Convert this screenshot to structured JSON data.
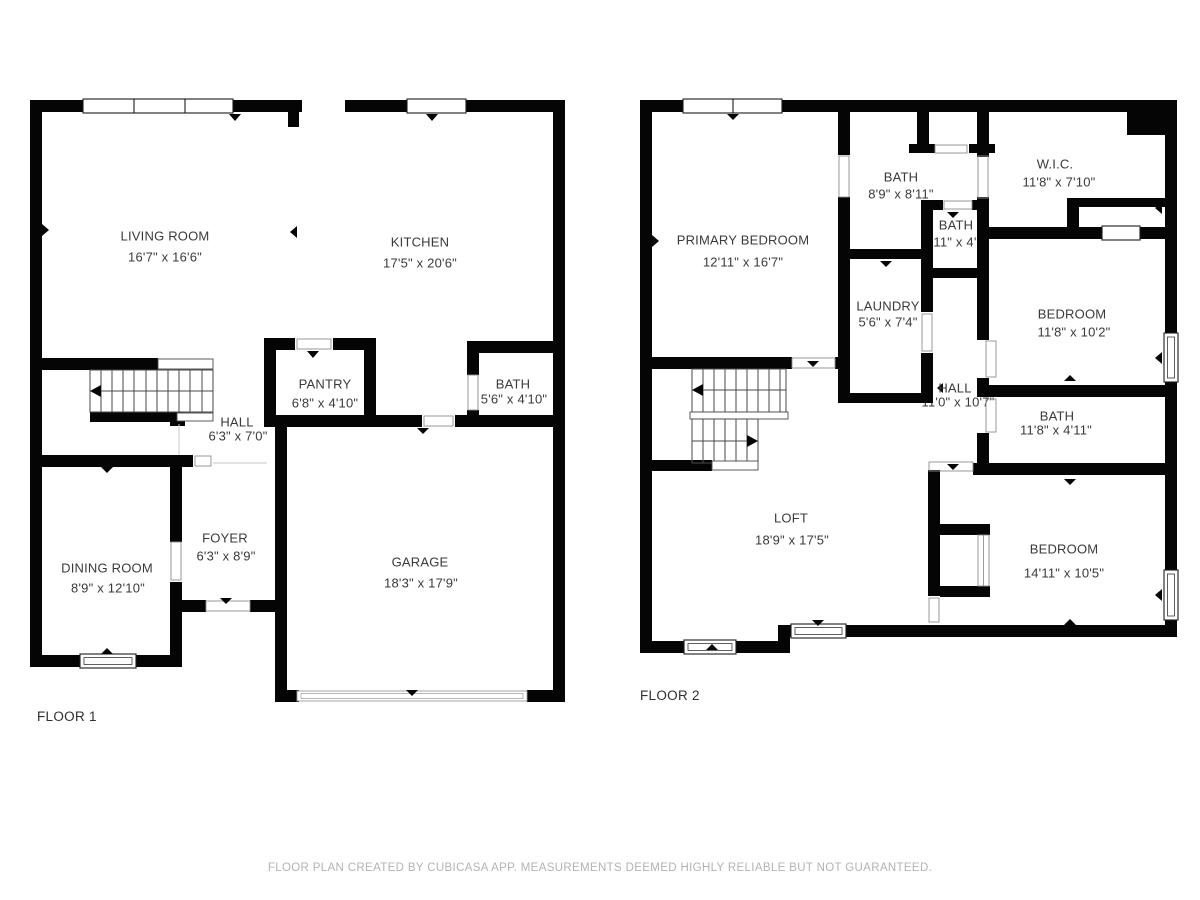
{
  "floor1": {
    "label": "FLOOR 1",
    "rooms": {
      "living_room": {
        "name": "LIVING ROOM",
        "dims": "16'7\" x 16'6\""
      },
      "kitchen": {
        "name": "KITCHEN",
        "dims": "17'5\" x 20'6\""
      },
      "hall": {
        "name": "HALL",
        "dims": "6'3\" x 7'0\""
      },
      "pantry": {
        "name": "PANTRY",
        "dims": "6'8\" x 4'10\""
      },
      "bath": {
        "name": "BATH",
        "dims": "5'6\" x 4'10\""
      },
      "foyer": {
        "name": "FOYER",
        "dims": "6'3\" x 8'9\""
      },
      "dining_room": {
        "name": "DINING ROOM",
        "dims": "8'9\" x 12'10\""
      },
      "garage": {
        "name": "GARAGE",
        "dims": "18'3\" x 17'9\""
      }
    }
  },
  "floor2": {
    "label": "FLOOR 2",
    "rooms": {
      "bath_upper": {
        "name": "BATH",
        "dims": "8'9\" x 8'11\""
      },
      "wic": {
        "name": "W.I.C.",
        "dims": "11'8\" x 7'10\""
      },
      "primary_bedroom": {
        "name": "PRIMARY BEDROOM",
        "dims": "12'11\" x 16'7\""
      },
      "bath_small": {
        "name": "BATH",
        "dims": "5'11\" x 4'2\""
      },
      "laundry": {
        "name": "LAUNDRY",
        "dims": "5'6\" x 7'4\""
      },
      "bedroom_upper": {
        "name": "BEDROOM",
        "dims": "11'8\" x 10'2\""
      },
      "hall": {
        "name": "HALL",
        "dims": "11'0\" x 10'7\""
      },
      "bath_wide": {
        "name": "BATH",
        "dims": "11'8\" x 4'11\""
      },
      "loft": {
        "name": "LOFT",
        "dims": "18'9\" x 17'5\""
      },
      "bedroom_lower": {
        "name": "BEDROOM",
        "dims": "14'11\" x 10'5\""
      }
    }
  },
  "footer": {
    "caption": "FLOOR PLAN CREATED BY CUBICASA APP. MEASUREMENTS DEEMED HIGHLY RELIABLE BUT NOT GUARANTEED."
  },
  "colors": {
    "wall": "#050505",
    "label_text": "#3a3a3a",
    "caption_text": "#b3b3b3"
  }
}
